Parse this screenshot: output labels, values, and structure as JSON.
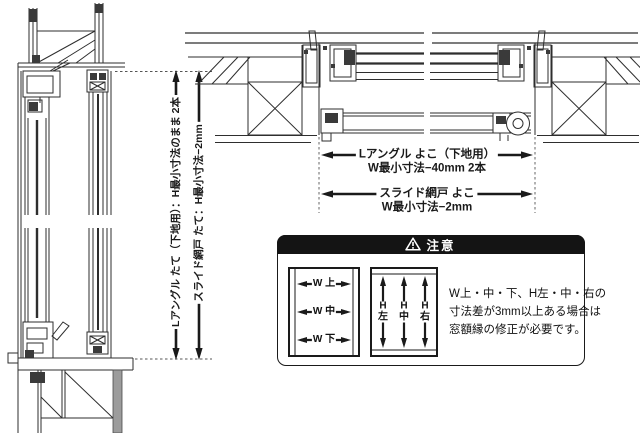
{
  "document": {
    "type": "window-installation-technical-diagram"
  },
  "left_section": {
    "dim1_label": "Lアングル たて（下地用）：H最小寸法のまま 2本",
    "dim2_label": "スライド網戸 たて：H最小寸法−2mm"
  },
  "top_section": {
    "dim1_line1": "Lアングル よこ（下地用）",
    "dim1_line2": "W最小寸法−40mm 2本",
    "dim2_line1": "スライド網戸 よこ",
    "dim2_line2": "W最小寸法−2mm"
  },
  "caution": {
    "title": "注意",
    "w_diagram": {
      "labels": [
        "W 上",
        "W 中",
        "W 下"
      ]
    },
    "h_diagram": {
      "labels": [
        "H\n左",
        "H\n中",
        "H\n右"
      ]
    },
    "note_lines": [
      "W上・中・下、H左・中・右の",
      "寸法差が3mm以上ある場合は",
      "窓額縁の修正が必要です。"
    ]
  },
  "colors": {
    "line": "#2e2e2e",
    "text": "#1a1a1a",
    "caution_bg": "#141414",
    "caution_fg": "#ffffff",
    "gray_fill": "#9c9c9c",
    "dark_fill": "#3a3a3a"
  }
}
